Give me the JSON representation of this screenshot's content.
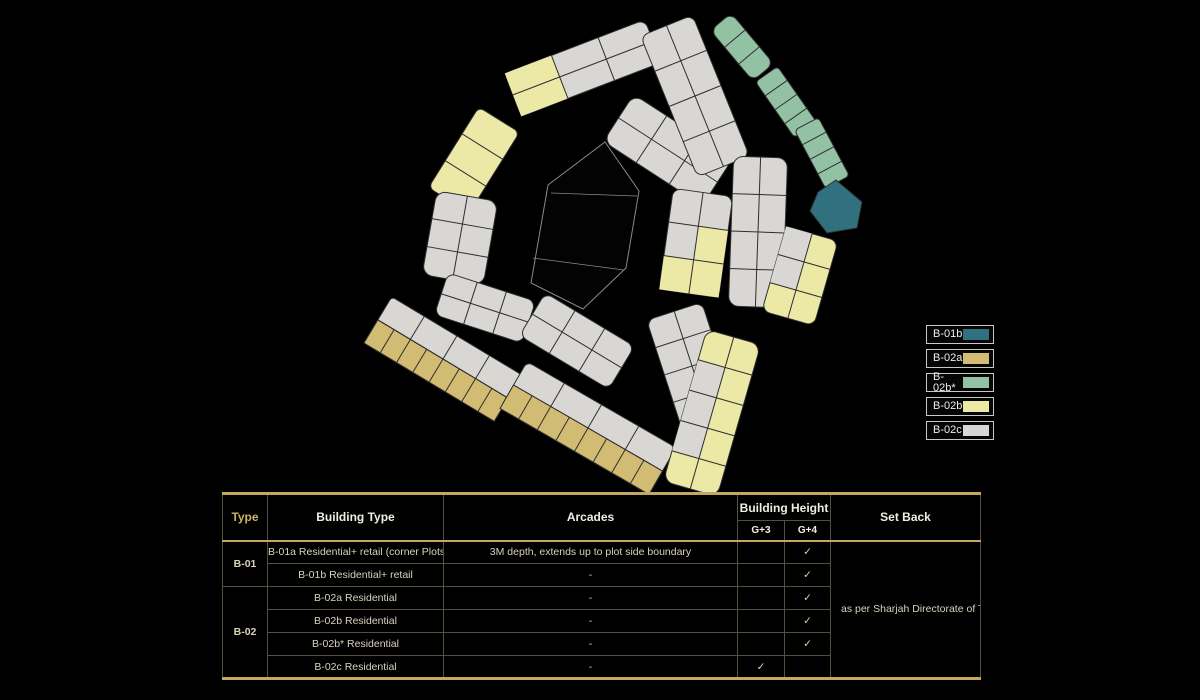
{
  "legend": {
    "items": [
      {
        "label": "B-01b",
        "color": "#31707f"
      },
      {
        "label": "B-02a",
        "color": "#d2bb72"
      },
      {
        "label": "B-02b*",
        "color": "#93c1a4"
      },
      {
        "label": "B-02b",
        "color": "#ece9a6"
      },
      {
        "label": "B-02c",
        "color": "#d8d7d4"
      }
    ]
  },
  "table": {
    "headers": {
      "type": "Type",
      "building_type": "Building Type",
      "arcades": "Arcades",
      "building_height": "Building Height",
      "g3": "G+3",
      "g4": "G+4",
      "set_back": "Set Back"
    },
    "groups": [
      {
        "label": "B-01"
      },
      {
        "label": "B-02"
      }
    ],
    "rows": [
      {
        "building_type": "B-01a Residential+ retail (corner Plots)",
        "arcades": "3M depth, extends up to plot side boundary",
        "g3": "",
        "g4": "✓"
      },
      {
        "building_type": "B-01b Residential+ retail",
        "arcades": "-",
        "g3": "",
        "g4": "✓"
      },
      {
        "building_type": "B-02a Residential",
        "arcades": "-",
        "g3": "",
        "g4": "✓"
      },
      {
        "building_type": "B-02b Residential",
        "arcades": "-",
        "g3": "",
        "g4": "✓"
      },
      {
        "building_type": "B-02b* Residential",
        "arcades": "-",
        "g3": "",
        "g4": "✓"
      },
      {
        "building_type": "B-02c Residential",
        "arcades": "-",
        "g3": "✓",
        "g4": ""
      }
    ],
    "set_back_note": "as per Sharjah Directorate of Town Planning & Survey requirements"
  },
  "map": {
    "stroke": "#2e2e2e",
    "void_stroke": "#8a8a8a",
    "colors": {
      "gray": "#d8d7d4",
      "paleyellow": "#ece9a6",
      "gold": "#d2bb72",
      "sage": "#93c1a4",
      "teal": "#31707f"
    },
    "blocks": [
      {
        "id": "northwest-strip",
        "color": "gray",
        "cx": 583,
        "cy": 68,
        "angle": -21,
        "len": 150,
        "wid": 46,
        "rows": 2,
        "cols": 3,
        "rx": 8,
        "ov": [
          [
            0,
            0,
            "paleyellow"
          ],
          [
            1,
            0,
            "paleyellow"
          ]
        ]
      },
      {
        "id": "west-yellow-arc",
        "color": "paleyellow",
        "cx": 474,
        "cy": 160,
        "angle": -58,
        "len": 95,
        "wid": 48,
        "rows": 1,
        "cols": 3,
        "rx": 6
      },
      {
        "id": "west-gray-block",
        "color": "gray",
        "cx": 460,
        "cy": 238,
        "angle": -80,
        "len": 85,
        "wid": 62,
        "rows": 2,
        "cols": 3,
        "rx": 10
      },
      {
        "id": "southwest-small-block",
        "color": "gray",
        "cx": 485,
        "cy": 308,
        "angle": 18,
        "len": 92,
        "wid": 44,
        "rows": 2,
        "cols": 3,
        "rx": 8
      },
      {
        "id": "south-small-block",
        "color": "gray",
        "cx": 577,
        "cy": 341,
        "angle": 31,
        "len": 104,
        "wid": 50,
        "rows": 2,
        "cols": 3,
        "rx": 8
      },
      {
        "id": "south-strip-1",
        "color": "gray",
        "cx": 443,
        "cy": 359,
        "angle": 31,
        "len": 152,
        "wid": 54,
        "rx": 4,
        "rows_spec": [
          {
            "color": "gray",
            "cells": 4
          },
          {
            "color": "gold",
            "cells": 8
          }
        ]
      },
      {
        "id": "south-strip-2",
        "color": "gray",
        "cx": 588,
        "cy": 428,
        "angle": 30,
        "len": 172,
        "wid": 54,
        "rx": 6,
        "rows_spec": [
          {
            "color": "gray",
            "cells": 4
          },
          {
            "color": "gold",
            "cells": 8
          }
        ]
      },
      {
        "id": "center-arc-a",
        "color": "gray",
        "cx": 668,
        "cy": 150,
        "angle": 33,
        "len": 118,
        "wid": 56,
        "rows": 2,
        "cols": 3,
        "rx": 10
      },
      {
        "id": "center-arc-b",
        "color": "gray",
        "cx": 696,
        "cy": 243,
        "angle": 98,
        "len": 102,
        "wid": 60,
        "rows": 2,
        "cols": 3,
        "rx": 8,
        "ov": [
          [
            0,
            1,
            "paleyellow"
          ],
          [
            0,
            2,
            "paleyellow"
          ],
          [
            1,
            2,
            "paleyellow"
          ]
        ]
      },
      {
        "id": "north-center-block",
        "color": "gray",
        "cx": 695,
        "cy": 96,
        "angle": 68,
        "len": 152,
        "wid": 56,
        "rows": 2,
        "cols": 4,
        "rx": 8
      },
      {
        "id": "south-center-block",
        "color": "gray",
        "cx": 692,
        "cy": 366,
        "angle": 72,
        "len": 115,
        "wid": 58,
        "rows": 2,
        "cols": 4,
        "rx": 8
      },
      {
        "id": "east-gray-strip",
        "color": "gray",
        "cx": 758,
        "cy": 232,
        "angle": 92,
        "len": 150,
        "wid": 54,
        "rows": 2,
        "cols": 4,
        "rx": 10
      },
      {
        "id": "southeast-strip",
        "color": "paleyellow",
        "cx": 712,
        "cy": 413,
        "angle": 106,
        "len": 158,
        "wid": 56,
        "rows": 2,
        "cols": 5,
        "rx": 10,
        "ov": [
          [
            1,
            1,
            "gray"
          ],
          [
            1,
            2,
            "gray"
          ],
          [
            1,
            3,
            "gray"
          ]
        ]
      },
      {
        "id": "east-yellow-strip",
        "color": "paleyellow",
        "cx": 800,
        "cy": 276,
        "angle": 106,
        "len": 88,
        "wid": 54,
        "rows": 2,
        "cols": 3,
        "rx": 8,
        "ov": [
          [
            1,
            0,
            "gray"
          ],
          [
            1,
            1,
            "gray"
          ]
        ]
      },
      {
        "id": "green-strip-1",
        "color": "sage",
        "cx": 742,
        "cy": 47,
        "angle": 50,
        "len": 66,
        "wid": 27,
        "rows": 1,
        "cols": 3,
        "rx": 8
      },
      {
        "id": "green-strip-2",
        "color": "sage",
        "cx": 786,
        "cy": 102,
        "angle": 55,
        "len": 68,
        "wid": 27,
        "rows": 1,
        "cols": 4,
        "rx": 0
      },
      {
        "id": "green-strip-3",
        "color": "sage",
        "cx": 822,
        "cy": 153,
        "angle": 62,
        "len": 66,
        "wid": 27,
        "rows": 1,
        "cols": 4,
        "rx": 4
      }
    ],
    "teal_plot": [
      [
        818,
        192
      ],
      [
        836,
        180
      ],
      [
        862,
        202
      ],
      [
        857,
        228
      ],
      [
        827,
        233
      ],
      [
        810,
        211
      ]
    ],
    "void_poly": [
      [
        605,
        142
      ],
      [
        639,
        191
      ],
      [
        626,
        268
      ],
      [
        583,
        309
      ],
      [
        531,
        283
      ],
      [
        548,
        185
      ]
    ],
    "void_lines": [
      [
        551,
        193,
        637,
        196
      ],
      [
        533,
        258,
        624,
        270
      ]
    ]
  }
}
